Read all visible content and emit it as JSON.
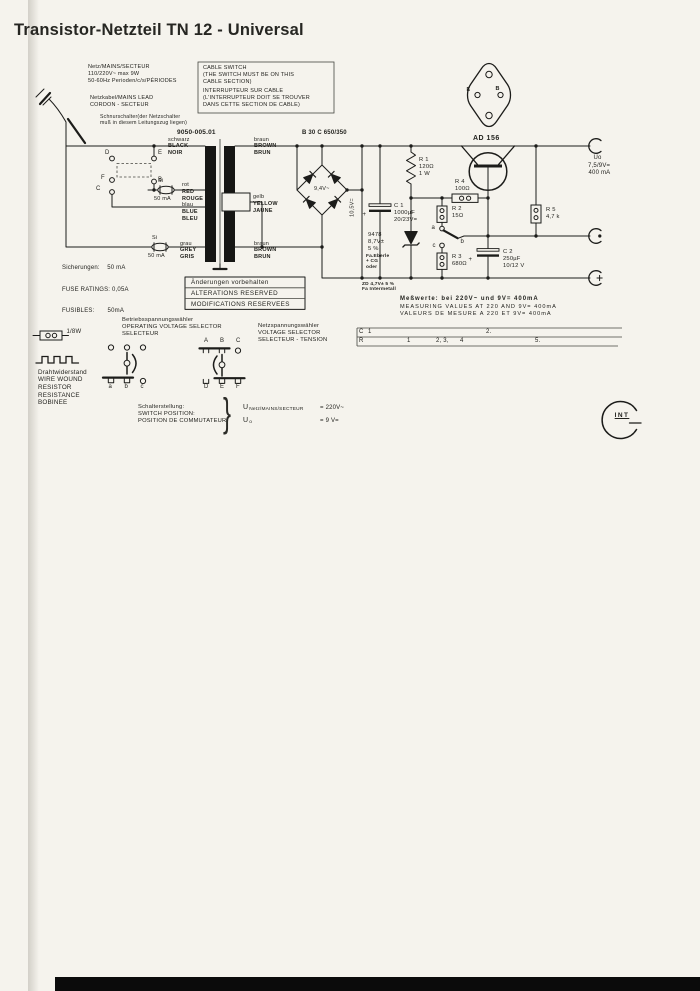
{
  "ink": "#1c1c1a",
  "paper": "#f5f3ed",
  "title": "Transistor-Netzteil TN 12 - Universal",
  "mains": {
    "info": [
      "Netz/MAINS/SECTEUR",
      "110/220V~ max 9W",
      "50-60Hz Perioden/c/s/PÉRIODES"
    ],
    "lead": [
      "Netzkabel/MAINS LEAD",
      "CORDON - SECTEUR"
    ],
    "cord_switch": [
      "Schnurschalter(der Netzschalter",
      "muß in diesem Leitungszug liegen)"
    ],
    "cable_switch": [
      "CABLE SWITCH",
      "(THE SWITCH MUST BE ON THIS",
      "CABLE SECTION)",
      "INTERRUPTEUR SUR CABLE",
      "(L'INTERRUPTEUR DOIT SE TROUVER",
      "DANS CETTE SECTION DE CABLE)"
    ],
    "fuse_si": "Si",
    "fuse_rating": "50 mA"
  },
  "transformer": {
    "part_number": "9050-005.01",
    "wire_black": [
      "schwarz",
      "BLACK",
      "NOIR"
    ],
    "wire_red": [
      "rot",
      "RED",
      "ROUGE"
    ],
    "wire_blue": [
      "blau",
      "BLUE",
      "BLEU"
    ],
    "wire_grey": [
      "grau",
      "GREY",
      "GRIS"
    ],
    "wire_brown_top": [
      "braun",
      "BROWN",
      "BRUN"
    ],
    "wire_yellow": [
      "gelb",
      "YELLOW",
      "JAUNE"
    ],
    "wire_brown_bottom": [
      "braun",
      "BROWN",
      "BRUN"
    ],
    "switch_contacts": {
      "d": "D",
      "e": "E",
      "f": "F",
      "c": "C",
      "b": "B"
    }
  },
  "rectifier": {
    "type": "B 30 C 650/350",
    "ac_voltage": "9,4V~",
    "dc_voltage": "10,5V="
  },
  "components": {
    "c1": [
      "C 1",
      "1000µF",
      "20/23V="
    ],
    "c1_plus": "+",
    "r1": [
      "R 1",
      "120Ω",
      "1 W"
    ],
    "r2": [
      "R 2",
      "15Ω"
    ],
    "r3": [
      "R 3",
      "680Ω"
    ],
    "r4": [
      "R 4",
      "100Ω"
    ],
    "r5": [
      "R 5",
      "4,7 k"
    ],
    "c2": [
      "C 2",
      "250µF",
      "10/12 V"
    ],
    "c2_plus": "+",
    "zener": [
      "9478",
      "8,7V±",
      "5 %"
    ],
    "zener_maker": [
      "Fa.Eberle",
      "+ CG",
      "oder"
    ],
    "zener_alt": [
      "ZD 4,7V± 5 %",
      "Fa Intermetall"
    ],
    "transistor": "AD 156",
    "package_pins": {
      "e": "E",
      "b": "B"
    },
    "sel_a": "a",
    "sel_b": "b",
    "sel_c": "c"
  },
  "output": {
    "uo": "Uo",
    "voltage": "7,5/9V=",
    "current": "400 mA"
  },
  "fuse_note": [
    "Sicherungen:    50 mA",
    "FUSE RATINGS: 0,05A",
    "FUSIBLES:       50mA"
  ],
  "changes_box": [
    "Änderungen vorbehalten",
    "ALTERATIONS RESERVED",
    "MODIFICATIONS RESERVEES"
  ],
  "measuring": [
    "Meßwerte: bei 220V~ und 9V= 400mA",
    "MEASURING VALUES AT 220 AND 9V= 400mA",
    "VALEURS DE MESURE A 220 ET 9V= 400mA"
  ],
  "index_table": {
    "row_c_label": "C",
    "row_c_cells": [
      "1",
      "2."
    ],
    "row_r_label": "R",
    "row_r_cells": [
      "1",
      "2, 3,",
      "4",
      "5."
    ]
  },
  "legend": {
    "power": "1/8W",
    "wire_wound": [
      "Drahtwiderstand",
      "WIRE WOUND",
      "RESISTOR",
      "RESISTANCE",
      "BOBINEE"
    ]
  },
  "operating_selector": {
    "title": [
      "Betriebsspannungswähler",
      "OPERATING VOLTAGE SELECTOR",
      "SELECTEUR"
    ],
    "bottom_left": [
      "a",
      "b",
      "c"
    ],
    "top_right": [
      "A",
      "B",
      "C"
    ],
    "bottom_right": [
      "D",
      "E",
      "F"
    ]
  },
  "mains_selector": [
    "Netzspannungswähler",
    "VOLTAGE SELECTOR",
    "SELECTEUR - TENSION"
  ],
  "switch_position": {
    "label": [
      "Schalterstellung:",
      "SWITCH POSITION:",
      "POSITION DE COMMUTATEUR"
    ],
    "brace": "}",
    "u1": "U",
    "u1_sub": "Netz/MAINS/SECTEUR",
    "u1_val": "= 220V~",
    "u2": "U",
    "u2_sub": "o",
    "u2_val": "= 9 V="
  },
  "logo": "INT"
}
